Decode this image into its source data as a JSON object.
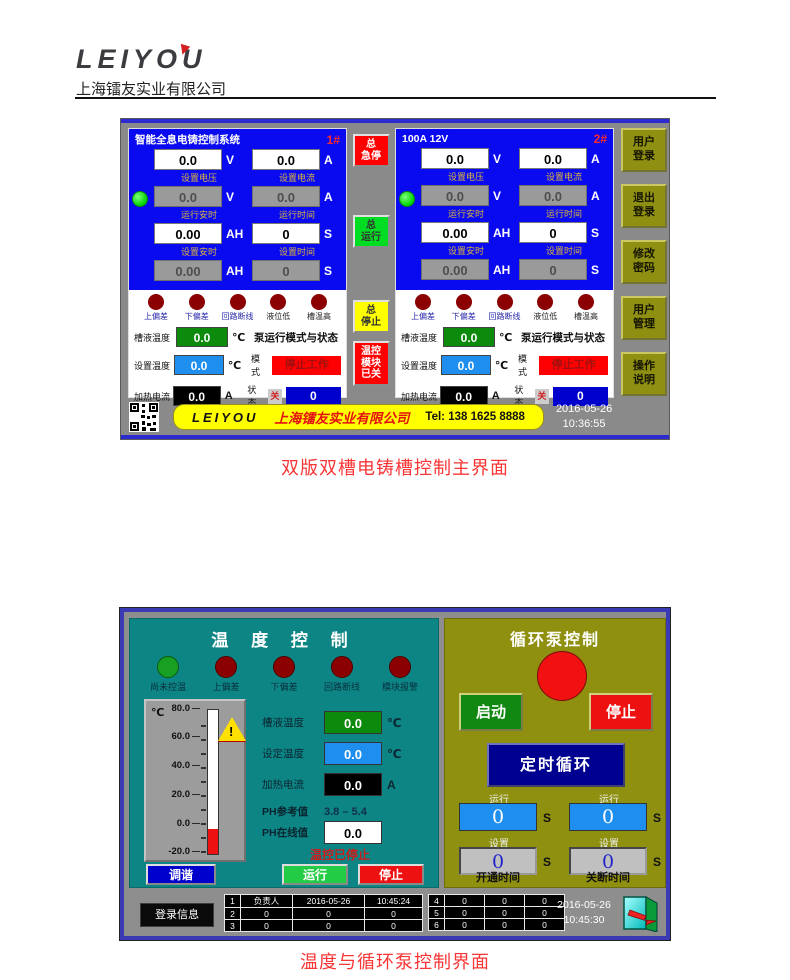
{
  "header": {
    "logo": "LEIYOU",
    "company": "上海镭友实业有限公司"
  },
  "captions": {
    "screen1": "双版双槽电铸槽控制主界面",
    "screen2": "温度与循环泵控制界面"
  },
  "screen1": {
    "labels": {
      "set_voltage": "设置电压",
      "set_current": "设置电流",
      "run_ah": "运行安时",
      "run_time": "运行时间",
      "set_ah": "设置安时",
      "set_time": "设置时间",
      "unit_v": "V",
      "unit_a": "A",
      "unit_ah": "AH",
      "unit_s": "S",
      "unit_c": "℃",
      "ind": [
        "上偏差",
        "下偏差",
        "回路断线",
        "液位低",
        "槽温高"
      ],
      "tank_temp": "槽液温度",
      "set_temp": "设置温度",
      "heat_current": "加热电流",
      "pump_header": "泵运行模式与状态",
      "mode": "模式",
      "mode_value": "停止工作",
      "status": "状态",
      "status_off": "关",
      "status_value": "0"
    },
    "panel1": {
      "title": "智能全息电铸控制系统",
      "num": "1#",
      "v": "0.0",
      "a": "0.0",
      "sv": "0.0",
      "sa": "0.0",
      "rah": "0.00",
      "rt": "0",
      "sah": "0.00",
      "st": "0",
      "tank": "0.0",
      "set": "0.0",
      "heat": "0.0"
    },
    "panel2": {
      "title": "100A 12V",
      "num": "2#",
      "v": "0.0",
      "a": "0.0",
      "sv": "0.0",
      "sa": "0.0",
      "rah": "0.00",
      "rt": "0",
      "sah": "0.00",
      "st": "0",
      "tank": "0.0",
      "set": "0.0",
      "heat": "0.0"
    },
    "mid_buttons": {
      "estop": [
        "总",
        "急停"
      ],
      "run": [
        "总",
        "运行"
      ],
      "stop": [
        "总",
        "停止"
      ],
      "temp_module": [
        "温控",
        "模块",
        "已关"
      ]
    },
    "right_buttons": [
      [
        "用户",
        "登录"
      ],
      [
        "退出",
        "登录"
      ],
      [
        "修改",
        "密码"
      ],
      [
        "用户",
        "管理"
      ],
      [
        "操作",
        "说明"
      ]
    ],
    "footer": {
      "logo": "LEIYOU",
      "company": "上海镭友实业有限公司",
      "tel": "Tel: 138 1625 8888",
      "date": "2016-05-26",
      "time": "10:36:55"
    }
  },
  "screen2": {
    "temp": {
      "title": "温 度 控 制",
      "ind": [
        "尚未控温",
        "上偏差",
        "下偏差",
        "回路断线",
        "模块报警"
      ],
      "thermo": {
        "unit": "℃",
        "ticks": [
          "80.0",
          "60.0",
          "40.0",
          "20.0",
          "0.0",
          "-20.0"
        ]
      },
      "rows": {
        "tank_label": "槽液温度",
        "tank": "0.0",
        "set_label": "设定温度",
        "set": "0.0",
        "heat_label": "加热电流",
        "heat": "0.0",
        "ph_ref_label": "PH参考值",
        "ph_ref": "3.8 – 5.4",
        "ph_live_label": "PH在线值",
        "ph_live": "0.0",
        "unit_c": "℃",
        "unit_a": "A"
      },
      "status": "温控已停止",
      "btn_tune": "调谐",
      "btn_run": "运行",
      "btn_stop": "停止"
    },
    "pump": {
      "title": "循环泵控制",
      "btn_start": "启动",
      "btn_stop": "停止",
      "btn_timer": "定时循环",
      "run_label": "运行",
      "set_label": "设置",
      "unit_s": "S",
      "run_on": "0",
      "run_off": "0",
      "set_on": "0",
      "set_off": "0",
      "on_time": "开通时间",
      "off_time": "关断时间"
    },
    "footer": {
      "login": "登录信息",
      "table1": [
        [
          "1",
          "负责人",
          "2016-05-26",
          "10:45:24"
        ],
        [
          "2",
          "0",
          "0",
          "0"
        ],
        [
          "3",
          "0",
          "0",
          "0"
        ]
      ],
      "table2": [
        [
          "4",
          "0",
          "0",
          "0"
        ],
        [
          "5",
          "0",
          "0",
          "0"
        ],
        [
          "6",
          "0",
          "0",
          "0"
        ]
      ],
      "date": "2016-05-26",
      "time": "10:45:30"
    }
  }
}
